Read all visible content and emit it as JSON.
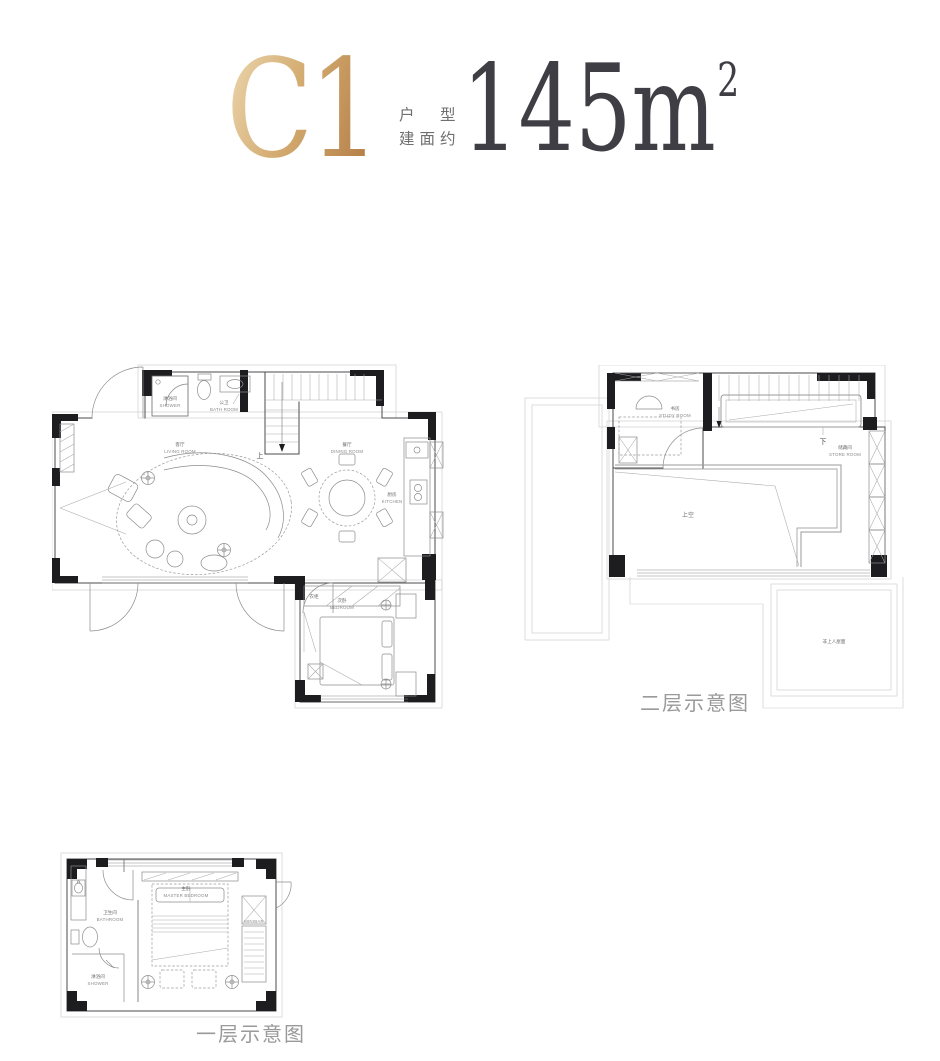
{
  "title": {
    "code": "C1",
    "label_line1": "户　型",
    "label_line2": "建面约",
    "area_value": "145m",
    "area_sup": "2"
  },
  "colors": {
    "gold_light": "#ecd6ae",
    "gold_dark": "#b27c45",
    "area_dark": "#3e3e44",
    "caption_gray": "#9a9a9a",
    "wall_black": "#1d1d20",
    "line_gray": "#8c8c8c"
  },
  "floor1_main": {
    "shower_cn": "淋浴间",
    "shower_en": "SHOWER",
    "bath_cn": "公卫",
    "bath_en": "BATH ROOM",
    "living_cn": "客厅",
    "living_en": "LIVING ROOM",
    "dining_cn": "餐厅",
    "dining_en": "DINING ROOM",
    "kitchen_cn": "厨房",
    "kitchen_en": "KITCHEN",
    "bedroom_cn": "次卧",
    "bedroom_en": "BEDROOM",
    "wardrobe_cn": "衣柜",
    "stairs_up": "上"
  },
  "floor2": {
    "study_cn": "书房",
    "study_en": "STUDY ROOM",
    "store_cn": "储藏间",
    "store_en": "STORE ROOM",
    "void_cn": "上空",
    "stairs_down": "下",
    "roof_cn": "非上人屋面",
    "caption": "二层示意图"
  },
  "floor1_master": {
    "master_cn": "主卧",
    "master_en": "MASTER BEDROOM",
    "bathroom_cn": "卫生间",
    "bathroom_en": "BATHROOM",
    "shower_cn": "淋浴间",
    "shower_en": "SHOWER",
    "minibar_en": "MINIBAR",
    "caption": "一层示意图"
  }
}
